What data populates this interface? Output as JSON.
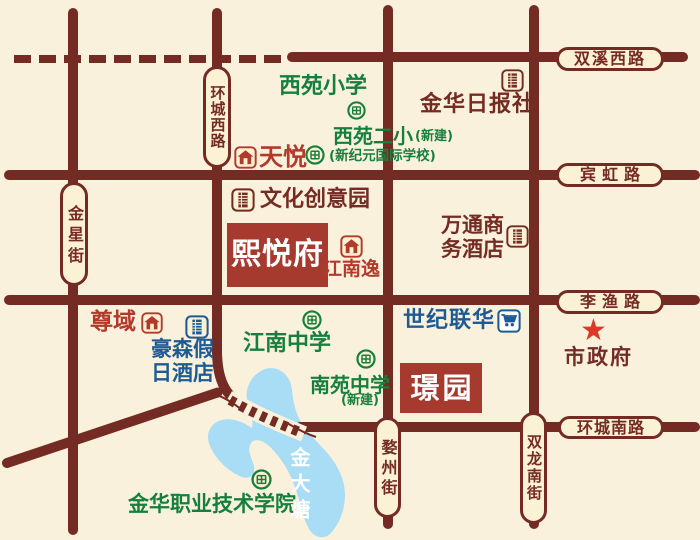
{
  "colors": {
    "background": "#FAF1DC",
    "road": "#742B24",
    "pill_fill": "#FBF1D5",
    "school_green": "#15803D",
    "dark_red_text": "#742B24",
    "project_red": "#B23A2B",
    "project_box_red": "#A63A2E",
    "hotel_blue": "#1E5B94",
    "lake_blue": "#A9DCF5",
    "star_red": "#DD3726"
  },
  "roads": {
    "shuangxi_west": "双溪西路",
    "binhong": "宾虹路",
    "liyu": "李渔路",
    "huancheng_south": "环城南路",
    "huancheng_west": "环城西路",
    "jinxing": "金星街",
    "wuzhou": "婺州街",
    "shuanglong_south": "双龙南街"
  },
  "schools": {
    "xiyuan_primary": "西苑小学",
    "xiyuan_second": "西苑二小",
    "xiyuan_second_note": "(新建)",
    "xinjiyuan_note": "(新纪元国际学校)",
    "jiangnan_middle": "江南中学",
    "nanyuan_middle": "南苑中学",
    "nanyuan_note": "(新建)",
    "polytechnic": "金华职业技术学院"
  },
  "landmarks": {
    "daily_press": "金华日报社",
    "cultural_park": "文化创意园",
    "wantong_line1": "万通商",
    "wantong_line2": "务酒店",
    "century_mart": "世纪联华",
    "haosen_line1": "豪森假",
    "haosen_line2": "日酒店",
    "city_hall": "市政府"
  },
  "projects": {
    "tianyue": "天悦",
    "zunyu": "尊域",
    "jiangnanyi": "江南逸",
    "xiyuefu": "熙悦府",
    "jingyuan": "璟园"
  },
  "lake": {
    "name": "金大塘"
  },
  "icons": {
    "star_glyph": "★"
  }
}
